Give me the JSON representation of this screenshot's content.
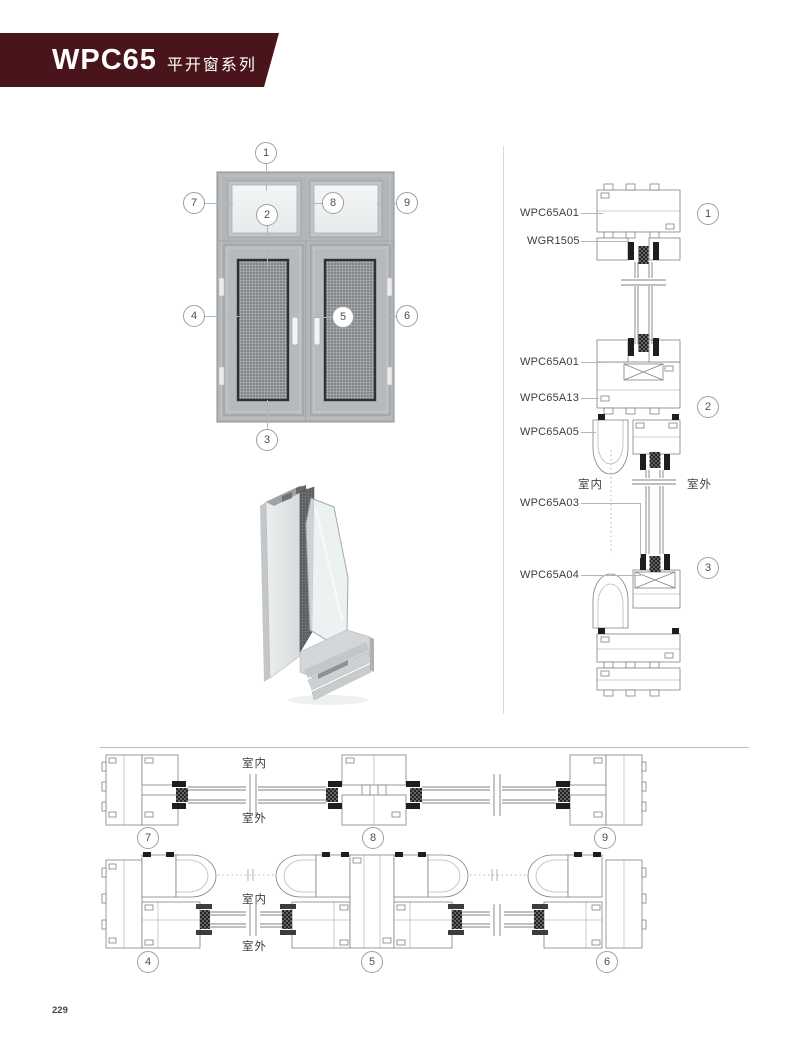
{
  "page": {
    "number": "229"
  },
  "header": {
    "series_code": "WPC65",
    "series_name": "平开窗系列",
    "banner_color": "#49151a"
  },
  "elevation": {
    "callouts": [
      "1",
      "2",
      "3",
      "4",
      "5",
      "6",
      "7",
      "8",
      "9"
    ]
  },
  "vsec": {
    "labels": [
      "WPC65A01",
      "WGR1505",
      "WPC65A01",
      "WPC65A13",
      "WPC65A05",
      "WPC65A03",
      "WPC65A04"
    ],
    "callouts": [
      "1",
      "2",
      "3"
    ],
    "indoor": "室内",
    "outdoor": "室外"
  },
  "rows": {
    "row1": {
      "callouts": [
        "7",
        "8",
        "9"
      ],
      "indoor": "室内",
      "outdoor": "室外"
    },
    "row2": {
      "callouts": [
        "4",
        "5",
        "6"
      ],
      "indoor": "室内",
      "outdoor": "室外"
    }
  },
  "colors": {
    "line": "#7d8285",
    "leader": "#b3b6b8",
    "callout_border": "#9aa0a3",
    "gasket": "#1c1e20"
  }
}
